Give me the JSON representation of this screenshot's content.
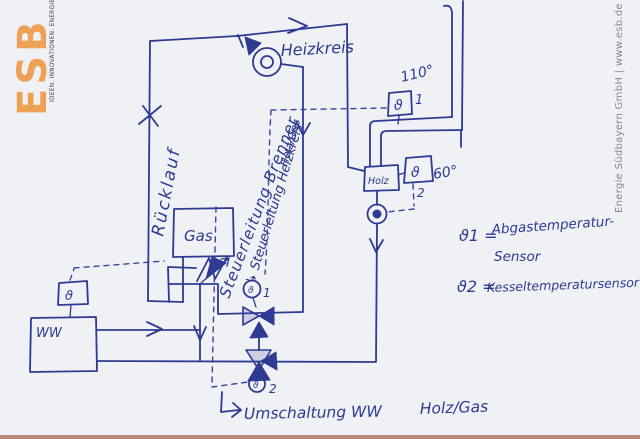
{
  "branding": {
    "logo": "ESB",
    "tagline": "IDEEN. INNOVATIONEN. ENERGIE.",
    "credit": "Energie Südbayern GmbH | www.esb.de"
  },
  "colors": {
    "ink": "#2d3b92",
    "paper": "#f0f1f4",
    "logo_orange": "#eea055",
    "credit_gray": "#85878c",
    "scan_edge": "#b07662"
  },
  "diagram": {
    "components": {
      "gas_boiler": "Gas",
      "wood_boiler": "Holz",
      "water_tank": "WW",
      "heating_circuit": "Heizkreis",
      "return_line": "Rücklauf"
    },
    "control_lines": {
      "burner": "Steuerleitung Brenner",
      "heating_circuit": "↳ Steuerleitung Heizkreis",
      "heating_circuit_2": "Holz/Gas"
    },
    "sensors": {
      "theta": "ϑ",
      "flue_temp": "110°",
      "flue_num": "1",
      "boiler_temp": "60°",
      "boiler_num": "2"
    },
    "valves": {
      "v1": "1",
      "v2": "2"
    },
    "note": {
      "part1": "Umschaltung WW",
      "part2": "Holz/Gas"
    },
    "legend": {
      "s1_sym": "ϑ1 =",
      "s1_text": "Abgastemperatur-",
      "s1_text2": "Sensor",
      "s2_sym": "ϑ2 =",
      "s2_text": "Kesseltemperatursensor"
    }
  }
}
